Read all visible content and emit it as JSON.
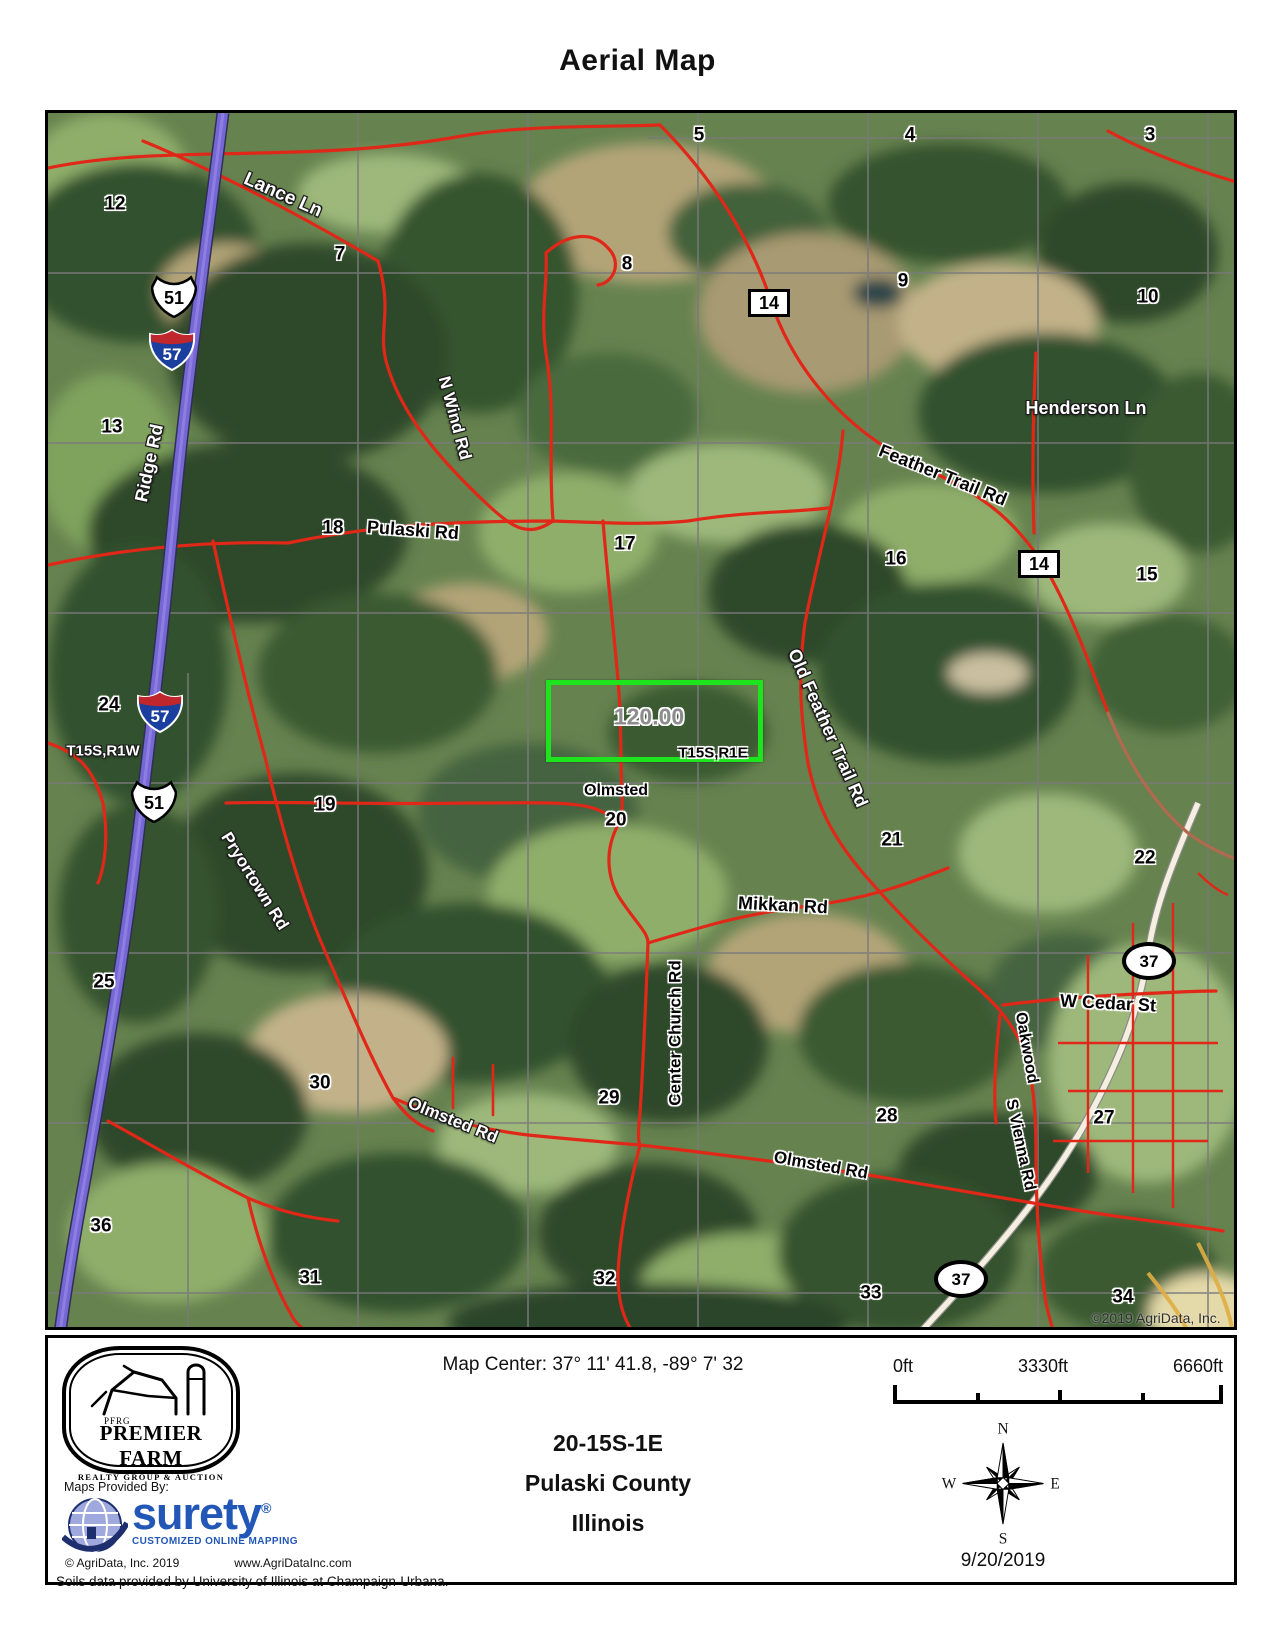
{
  "title": "Aerial Map",
  "accent": {
    "road_red": "#e02718",
    "interstate_purple": "#7668d4",
    "parcel_green": "#1de41d",
    "interstate_shield_blue": "#1b3f9e",
    "interstate_shield_red": "#c0272d",
    "logo_blue": "#2257b8"
  },
  "map": {
    "copyright": "©2019 AgriData, Inc.",
    "parcel_acres": "120.00",
    "townships": {
      "left": "T15S,R1W",
      "right": "T15S,R1E"
    },
    "town": "Olmsted",
    "sections": [
      {
        "n": "5",
        "x": 651,
        "y": 22
      },
      {
        "n": "4",
        "x": 862,
        "y": 22
      },
      {
        "n": "3",
        "x": 1102,
        "y": 22
      },
      {
        "n": "12",
        "x": 67,
        "y": 91
      },
      {
        "n": "7",
        "x": 292,
        "y": 141
      },
      {
        "n": "8",
        "x": 579,
        "y": 151
      },
      {
        "n": "9",
        "x": 855,
        "y": 168
      },
      {
        "n": "10",
        "x": 1100,
        "y": 184
      },
      {
        "n": "13",
        "x": 64,
        "y": 314
      },
      {
        "n": "18",
        "x": 285,
        "y": 415
      },
      {
        "n": "17",
        "x": 577,
        "y": 431
      },
      {
        "n": "16",
        "x": 848,
        "y": 446
      },
      {
        "n": "15",
        "x": 1099,
        "y": 462
      },
      {
        "n": "24",
        "x": 61,
        "y": 592
      },
      {
        "n": "19",
        "x": 277,
        "y": 692
      },
      {
        "n": "20",
        "x": 568,
        "y": 707
      },
      {
        "n": "21",
        "x": 844,
        "y": 727
      },
      {
        "n": "22",
        "x": 1097,
        "y": 745
      },
      {
        "n": "25",
        "x": 56,
        "y": 869
      },
      {
        "n": "30",
        "x": 272,
        "y": 970
      },
      {
        "n": "29",
        "x": 561,
        "y": 985
      },
      {
        "n": "28",
        "x": 839,
        "y": 1003
      },
      {
        "n": "27",
        "x": 1056,
        "y": 1005
      },
      {
        "n": "36",
        "x": 53,
        "y": 1113
      },
      {
        "n": "31",
        "x": 262,
        "y": 1165
      },
      {
        "n": "32",
        "x": 557,
        "y": 1166
      },
      {
        "n": "33",
        "x": 823,
        "y": 1180
      },
      {
        "n": "34",
        "x": 1075,
        "y": 1184
      }
    ],
    "road_labels": [
      {
        "t": "Lance Ln",
        "x": 235,
        "y": 82,
        "r": 24,
        "s": "w",
        "fs": 19
      },
      {
        "t": "N Wind Rd",
        "x": 407,
        "y": 305,
        "r": 75,
        "s": "w",
        "fs": 17
      },
      {
        "t": "Ridge Rd",
        "x": 101,
        "y": 350,
        "r": -78,
        "s": "w",
        "fs": 18
      },
      {
        "t": "Pulaski Rd",
        "x": 365,
        "y": 417,
        "r": 4,
        "s": "b",
        "fs": 18
      },
      {
        "t": "Feather Trail Rd",
        "x": 895,
        "y": 362,
        "r": 22,
        "s": "b",
        "fs": 18
      },
      {
        "t": "Henderson Ln",
        "x": 1038,
        "y": 295,
        "r": 0,
        "s": "w",
        "fs": 18
      },
      {
        "t": "Old Feather Trail Rd",
        "x": 780,
        "y": 615,
        "r": 66,
        "s": "w",
        "fs": 18
      },
      {
        "t": "T15S,R1W",
        "x": 55,
        "y": 638,
        "r": 0,
        "s": "w",
        "fs": 15
      },
      {
        "t": "T15S,R1E",
        "x": 665,
        "y": 640,
        "r": 0,
        "s": "b",
        "fs": 15
      },
      {
        "t": "120.00",
        "x": 601,
        "y": 604,
        "r": 0,
        "s": "a",
        "fs": 23
      },
      {
        "t": "Olmsted",
        "x": 568,
        "y": 678,
        "r": 0,
        "s": "b",
        "fs": 16
      },
      {
        "t": "Pryortown Rd",
        "x": 207,
        "y": 768,
        "r": 58,
        "s": "w",
        "fs": 17
      },
      {
        "t": "Mikkan Rd",
        "x": 735,
        "y": 792,
        "r": 3,
        "s": "b",
        "fs": 18
      },
      {
        "t": "Center Church Rd",
        "x": 627,
        "y": 920,
        "r": -90,
        "s": "b",
        "fs": 17
      },
      {
        "t": "W Cedar St",
        "x": 1060,
        "y": 890,
        "r": 3,
        "s": "b",
        "fs": 18
      },
      {
        "t": "Oakwood",
        "x": 978,
        "y": 935,
        "r": 80,
        "s": "b",
        "fs": 16
      },
      {
        "t": "S Vienna Rd",
        "x": 972,
        "y": 1032,
        "r": 78,
        "s": "b",
        "fs": 16
      },
      {
        "t": "Olmsted Rd",
        "x": 405,
        "y": 1007,
        "r": 22,
        "s": "w",
        "fs": 17
      },
      {
        "t": "Olmsted Rd",
        "x": 773,
        "y": 1052,
        "r": 10,
        "s": "b",
        "fs": 17
      },
      {
        "t": "©2019 AgriData, Inc.",
        "x": 1108,
        "y": 1205,
        "r": 0,
        "s": "c",
        "fs": 14
      }
    ],
    "shields": [
      {
        "k": "us",
        "t": "51",
        "x": 126,
        "y": 183
      },
      {
        "k": "i",
        "t": "57",
        "x": 124,
        "y": 237
      },
      {
        "k": "box",
        "t": "14",
        "x": 721,
        "y": 190
      },
      {
        "k": "box",
        "t": "14",
        "x": 991,
        "y": 451
      },
      {
        "k": "i",
        "t": "57",
        "x": 112,
        "y": 599
      },
      {
        "k": "us",
        "t": "51",
        "x": 106,
        "y": 688
      },
      {
        "k": "oval",
        "t": "37",
        "x": 1101,
        "y": 848
      },
      {
        "k": "oval",
        "t": "37",
        "x": 913,
        "y": 1166
      }
    ]
  },
  "footer": {
    "map_center": "Map Center: 37° 11' 41.8,  -89° 7' 32",
    "location": {
      "trs": "20-15S-1E",
      "county": "Pulaski County",
      "state": "Illinois"
    },
    "scale": {
      "start": "0ft",
      "mid": "3330ft",
      "end": "6660ft"
    },
    "compass": {
      "n": "N",
      "e": "E",
      "s": "S",
      "w": "W"
    },
    "date": "9/20/2019",
    "maps_provided": "Maps Provided By:",
    "brand": {
      "pfrg": "PFRG",
      "name": "PREMIER FARM",
      "tagline": "REALTY GROUP & AUCTION"
    },
    "surety": {
      "name": "surety",
      "reg": "®",
      "tagline": "CUSTOMIZED ONLINE MAPPING"
    },
    "agridata_line": {
      "left": "© AgriData, Inc. 2019",
      "right": "www.AgriDataInc.com"
    },
    "soils": "Soils data provided by University of Illinois at Champaign-Urbana."
  }
}
